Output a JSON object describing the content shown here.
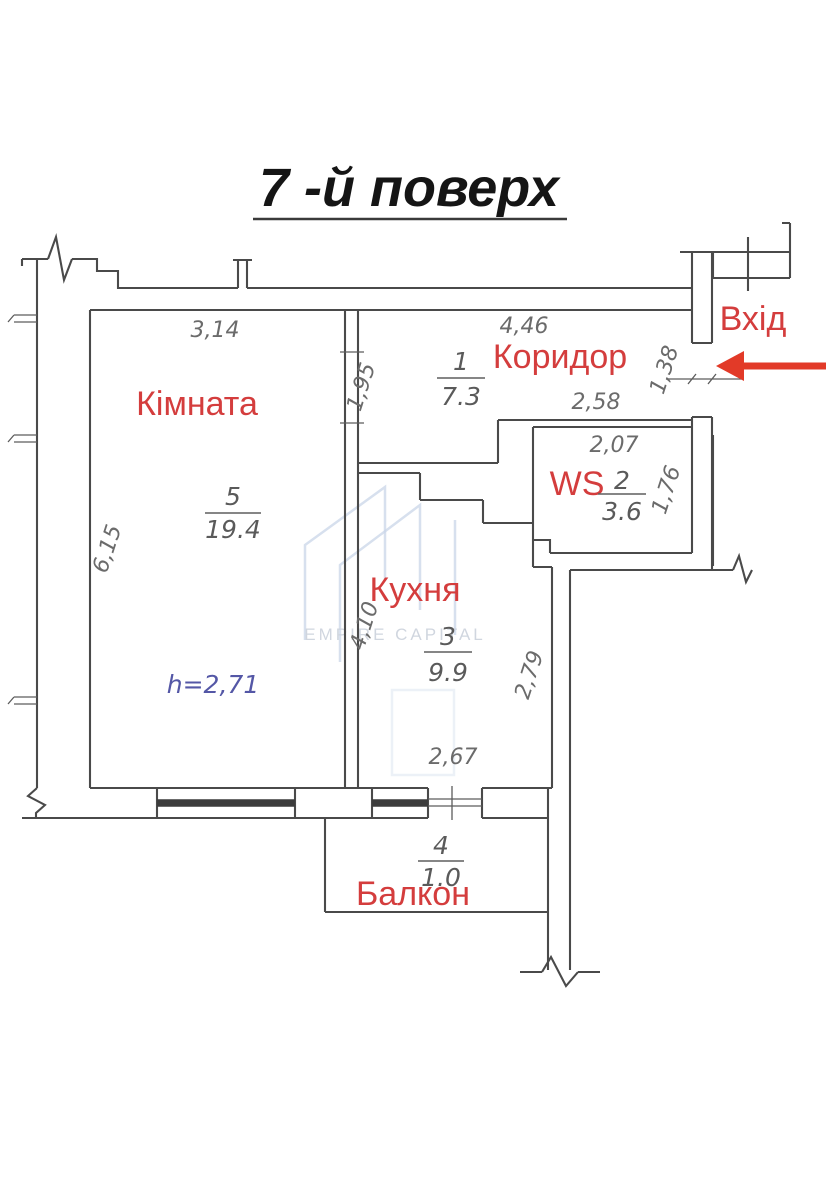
{
  "title": "7 -й поверх",
  "entrance": {
    "label": "Вхід"
  },
  "rooms": {
    "kimnata": {
      "label": "Кімната",
      "number": "5",
      "area": "19.4"
    },
    "korydor": {
      "label": "Коридор",
      "number": "1",
      "area": "7.3"
    },
    "ws": {
      "label": "WS",
      "number": "2",
      "area": "3.6"
    },
    "kukhnia": {
      "label": "Кухня",
      "number": "3",
      "area": "9.9"
    },
    "balkon": {
      "label": "Балкон",
      "number": "4",
      "area": "1.0"
    }
  },
  "ceiling_height": "h=2,71",
  "dimensions": {
    "room_top": "3,14",
    "room_left": "6,15",
    "corridor_top": "4,46",
    "corridor_left": "1,95",
    "corridor_bottom": "2,58",
    "entrance_opening": "1,38",
    "ws_top": "2,07",
    "ws_right": "1,76",
    "kitchen_left": "4,10",
    "kitchen_right": "2,79",
    "kitchen_bottom": "2,67"
  },
  "watermark": "EMPIRE CAPITAL",
  "colors": {
    "label_red": "#d43d3d",
    "arrow_red": "#e23a28",
    "wall": "#4a4a4a",
    "dim_text": "#6b6b6b",
    "height_blue": "#5457a6",
    "watermark": "#c9d6e8",
    "watermark_text": "#ccd2dc",
    "title": "#151515"
  }
}
